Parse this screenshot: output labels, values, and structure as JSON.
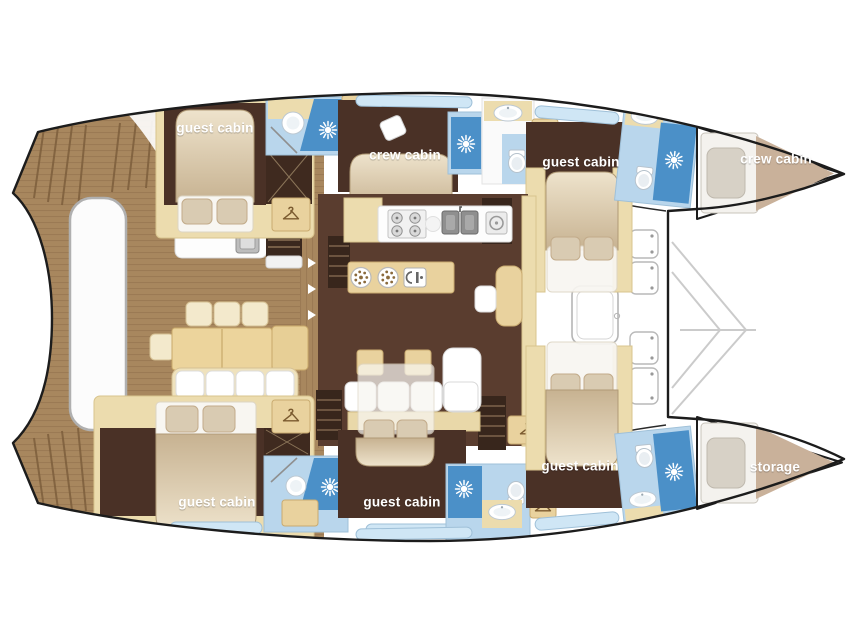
{
  "rooms": [
    {
      "id": "guest-cabin-aft-port",
      "label": "guest cabin"
    },
    {
      "id": "crew-cabin-main",
      "label": "crew cabin"
    },
    {
      "id": "guest-cabin-fwd-port",
      "label": "guest cabin"
    },
    {
      "id": "crew-cabin-bow",
      "label": "crew cabin"
    },
    {
      "id": "guest-cabin-fwd-stbd",
      "label": "guest cabin"
    },
    {
      "id": "storage-bow",
      "label": "storage"
    },
    {
      "id": "guest-cabin-aft-stbd",
      "label": "guest cabin"
    },
    {
      "id": "guest-cabin-mid-stbd",
      "label": "guest cabin"
    }
  ],
  "icons": {
    "shower": "shower-jet-starburst",
    "wardrobe": "clothes-hanger",
    "stove": "four-burner-hob",
    "sink": "double-sink",
    "toilet": "toilet",
    "washbasin": "washbasin"
  },
  "colors": {
    "hull_outline": "#1c1c1c",
    "deck_wood": "#a8875e",
    "cabin_floor": "#4a3126",
    "salon_floor": "#5a3d2f",
    "joinery_cream": "#ecdcae",
    "furniture_tan": "#e9d29e",
    "bathroom_blue": "#b9d6ec",
    "shower_blue": "#4b90c8",
    "bow_locker_tan": "#c9b19a",
    "label_text": "#ffffff"
  }
}
